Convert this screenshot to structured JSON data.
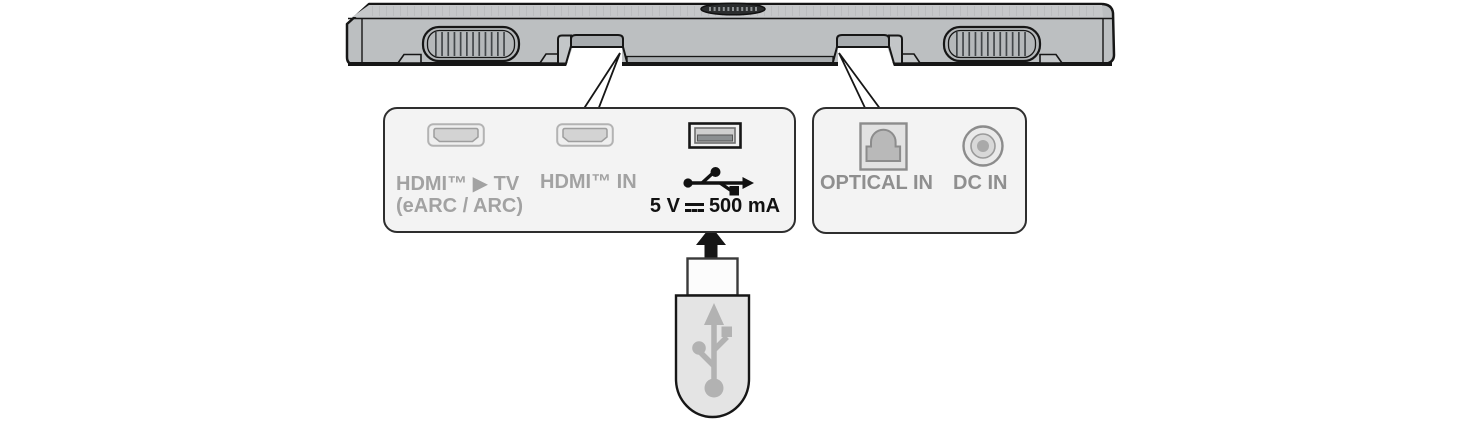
{
  "panels": {
    "left": {
      "hdmi_tv_line1": "HDMI™ ▶ TV",
      "hdmi_tv_line2": "(eARC / ARC)",
      "hdmi_in": "HDMI™ IN",
      "usb_power_prefix": "5 V",
      "usb_power_suffix": "500 mA"
    },
    "right": {
      "optical": "OPTICAL IN",
      "dc": "DC IN"
    }
  },
  "icons": {
    "hdmi_port": "hdmi-connector",
    "usb_port": "usb-a-connector",
    "usb_symbol": "usb-trident",
    "optical_port": "toslink-connector",
    "dc_port": "barrel-jack",
    "insert_arrow": "up-arrow",
    "dc_voltage_symbol": "solid-line-over-dashed-line",
    "usb_drive": "usb-flash-drive"
  },
  "colors": {
    "soundbar_body": "#bcbfc1",
    "soundbar_outline": "#161616",
    "panel_fill": "#f3f3f3",
    "panel_border": "#2e2e2e",
    "port_label_gray": "#9b9b9b",
    "usb_power_text": "#111111",
    "usb_drive_body": "#e4e4e4",
    "usb_trident_gray": "#b2b2b2"
  }
}
